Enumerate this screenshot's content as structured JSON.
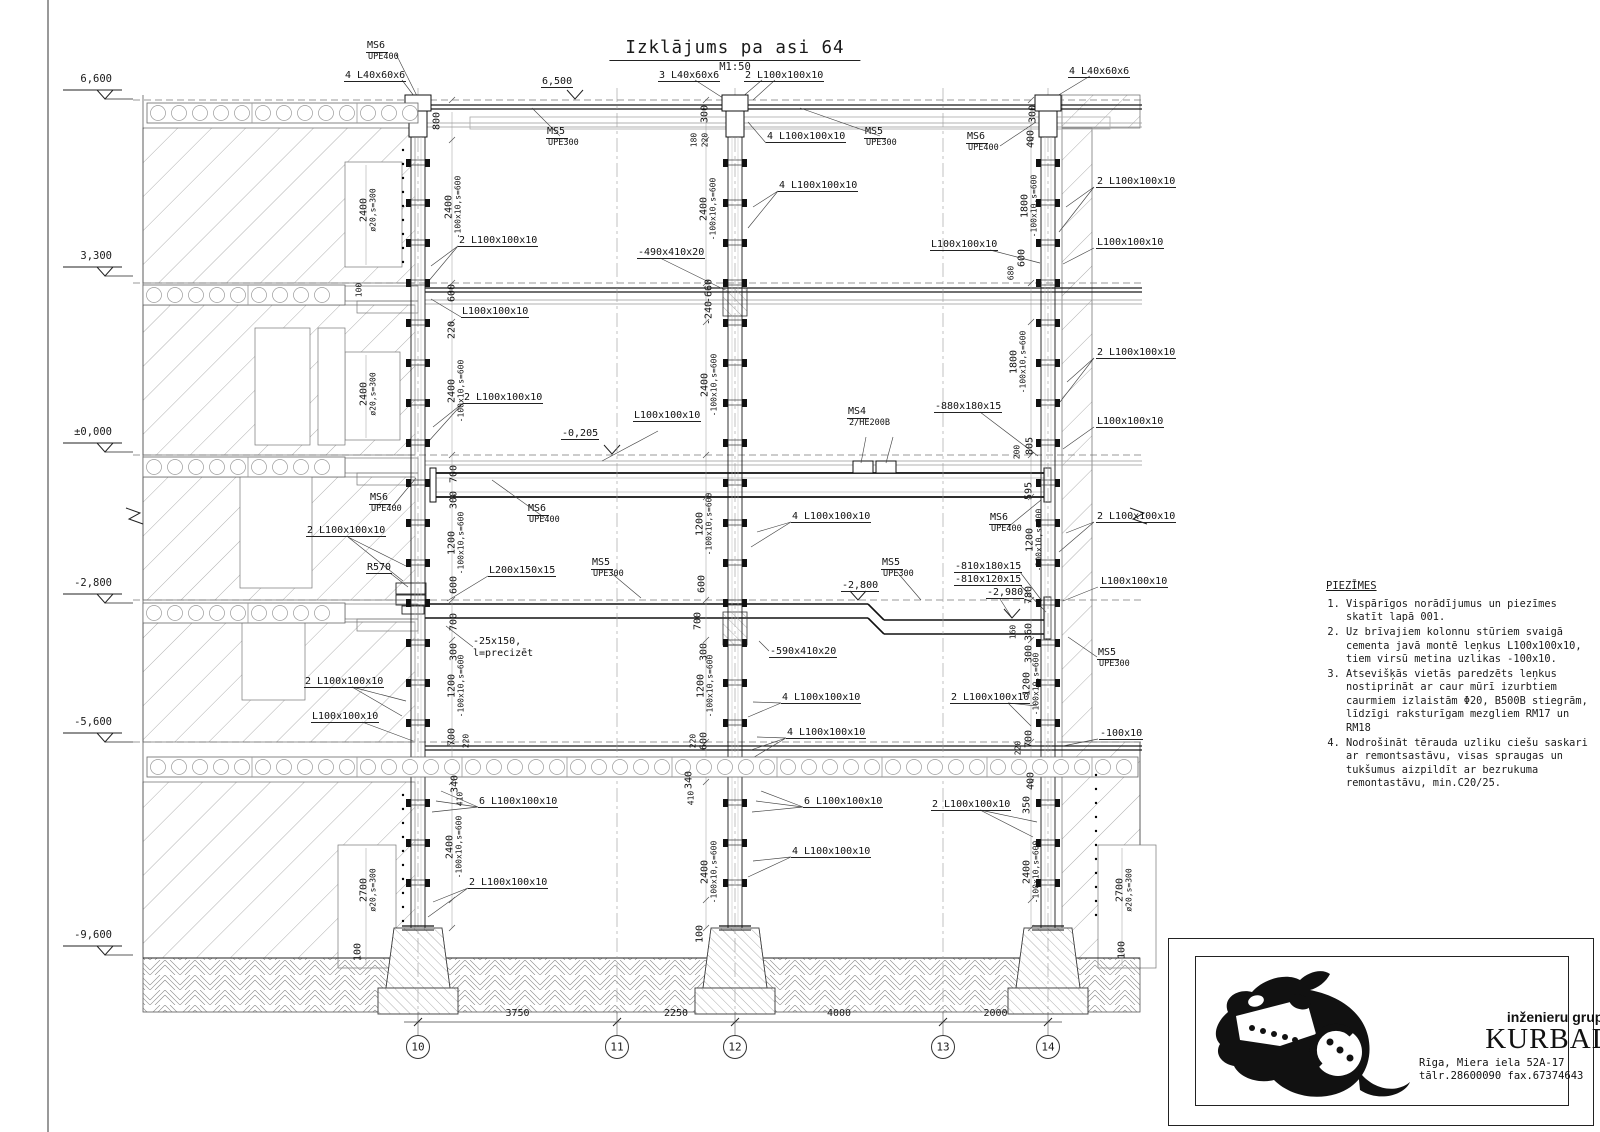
{
  "sheet": {
    "title": "Izklājums pa asi 64",
    "scale": "M1:50"
  },
  "elevation_markers": [
    {
      "label": "6,600",
      "y": 99
    },
    {
      "label": "3,300",
      "y": 276
    },
    {
      "label": "±0,000",
      "y": 452
    },
    {
      "label": "-2,800",
      "y": 603
    },
    {
      "label": "-5,600",
      "y": 742
    },
    {
      "label": "-9,600",
      "y": 955
    }
  ],
  "axes": {
    "bubbles": [
      {
        "label": "10",
        "x": 418
      },
      {
        "label": "11",
        "x": 617
      },
      {
        "label": "12",
        "x": 735
      },
      {
        "label": "13",
        "x": 943
      },
      {
        "label": "14",
        "x": 1048
      }
    ],
    "spans": [
      {
        "label": "3750"
      },
      {
        "label": "2250"
      },
      {
        "label": "4000"
      },
      {
        "label": "2000"
      }
    ]
  },
  "notes": {
    "heading": "PIEZĪMES",
    "items": [
      "Vispārīgos norādījumus un piezīmes skatīt lapā 001.",
      "Uz brīvajiem kolonnu stūriem svaigā cementa javā montē leņkus L100x100x10, tiem virsū metina uzlikas -100x10.",
      "Atsevišķās vietās paredzēts leņkus nostiprināt ar caur mūrī izurbtiem caurmiem izlaistām Φ20, B500B stiegrām, līdzīgi raksturīgam mezgliem RM17 un RM18",
      "Nodrošināt tērauda uzliku ciešu saskari ar remontsastāvu, visas spraugas un tukšumus aizpildīt ar bezrukuma remontastāvu, min.C20/25."
    ]
  },
  "title_block": {
    "tagline": "inženieru grupa",
    "company": "KURBADS",
    "address": "Rīga, Miera iela 52A-17",
    "contacts": "tālr.28600090 fax.67374643"
  },
  "annotations": [
    {
      "t": "MS6",
      "sub": "UPE400",
      "x": 366,
      "y": 40
    },
    {
      "t": "4 L40x60x6",
      "x": 344,
      "y": 70,
      "u": 1
    },
    {
      "t": "6,500",
      "x": 541,
      "y": 76,
      "u": 1
    },
    {
      "t": "3 L40x60x6",
      "x": 658,
      "y": 70,
      "u": 1
    },
    {
      "t": "2 L100x100x10",
      "x": 744,
      "y": 70,
      "u": 1
    },
    {
      "t": "4 L40x60x6",
      "x": 1068,
      "y": 66,
      "u": 1
    },
    {
      "t": "MS5",
      "sub": "UPE300",
      "x": 546,
      "y": 126
    },
    {
      "t": "4 L100x100x10",
      "x": 766,
      "y": 131,
      "u": 1
    },
    {
      "t": "MS5",
      "sub": "UPE300",
      "x": 864,
      "y": 126
    },
    {
      "t": "MS6",
      "sub": "UPE400",
      "x": 966,
      "y": 131
    },
    {
      "t": "2 L100x100x10",
      "x": 1096,
      "y": 176,
      "u": 1
    },
    {
      "t": "4 L100x100x10",
      "x": 778,
      "y": 180,
      "u": 1
    },
    {
      "t": "2 L100x100x10",
      "x": 458,
      "y": 235,
      "u": 1
    },
    {
      "t": "-490x410x20",
      "x": 637,
      "y": 247,
      "u": 1
    },
    {
      "t": "L100x100x10",
      "x": 930,
      "y": 239,
      "u": 1
    },
    {
      "t": "L100x100x10",
      "x": 1096,
      "y": 237,
      "u": 1
    },
    {
      "t": "L100x100x10",
      "x": 461,
      "y": 306,
      "u": 1
    },
    {
      "t": "2 L100x100x10",
      "x": 1096,
      "y": 347,
      "u": 1
    },
    {
      "t": "2 L100x100x10",
      "x": 463,
      "y": 392,
      "u": 1
    },
    {
      "t": "L100x100x10",
      "x": 633,
      "y": 410,
      "u": 1
    },
    {
      "t": "MS4",
      "sub": "2/HE200B",
      "x": 847,
      "y": 406
    },
    {
      "t": "-880x180x15",
      "x": 934,
      "y": 401,
      "u": 1
    },
    {
      "t": "-0,205",
      "x": 561,
      "y": 428,
      "u": 1
    },
    {
      "t": "L100x100x10",
      "x": 1096,
      "y": 416,
      "u": 1
    },
    {
      "t": "MS6",
      "sub": "UPE400",
      "x": 369,
      "y": 492
    },
    {
      "t": "MS6",
      "sub": "UPE400",
      "x": 527,
      "y": 503
    },
    {
      "t": "4 L100x100x10",
      "x": 791,
      "y": 511,
      "u": 1
    },
    {
      "t": "MS6",
      "sub": "UPE400",
      "x": 989,
      "y": 512
    },
    {
      "t": "2 L100x100x10",
      "x": 1096,
      "y": 511,
      "u": 1
    },
    {
      "t": "2 L100x100x10",
      "x": 306,
      "y": 525,
      "u": 1
    },
    {
      "t": "R570",
      "x": 366,
      "y": 562,
      "u": 1
    },
    {
      "t": "L200x150x15",
      "x": 488,
      "y": 565,
      "u": 1
    },
    {
      "t": "MS5",
      "sub": "UPE300",
      "x": 591,
      "y": 557
    },
    {
      "t": "MS5",
      "sub": "UPE300",
      "x": 881,
      "y": 557
    },
    {
      "t": "-810x180x15",
      "x": 954,
      "y": 561,
      "u": 1
    },
    {
      "t": "-810x120x15",
      "x": 954,
      "y": 574,
      "u": 1
    },
    {
      "t": "-2,800",
      "x": 841,
      "y": 580,
      "u": 1
    },
    {
      "t": "-2,980",
      "x": 986,
      "y": 587,
      "u": 1
    },
    {
      "t": "L100x100x10",
      "x": 1100,
      "y": 576,
      "u": 1
    },
    {
      "t": "-25x150,",
      "x": 473,
      "y": 636
    },
    {
      "t": "l=precizēt",
      "x": 473,
      "y": 648
    },
    {
      "t": "MS5",
      "sub": "UPE300",
      "x": 1097,
      "y": 647
    },
    {
      "t": "2 L100x100x10",
      "x": 950,
      "y": 692,
      "u": 1
    },
    {
      "t": "4 L100x100x10",
      "x": 781,
      "y": 692,
      "u": 1
    },
    {
      "t": "-590x410x20",
      "x": 769,
      "y": 646,
      "u": 1
    },
    {
      "t": "-100x10",
      "x": 1099,
      "y": 728,
      "u": 1
    },
    {
      "t": "2 L100x100x10",
      "x": 304,
      "y": 676,
      "u": 1
    },
    {
      "t": "L100x100x10",
      "x": 311,
      "y": 711,
      "u": 1
    },
    {
      "t": "4 L100x100x10",
      "x": 786,
      "y": 727,
      "u": 1
    },
    {
      "t": "6 L100x100x10",
      "x": 478,
      "y": 796,
      "u": 1
    },
    {
      "t": "6 L100x100x10",
      "x": 803,
      "y": 796,
      "u": 1
    },
    {
      "t": "2 L100x100x10",
      "x": 468,
      "y": 877,
      "u": 1
    },
    {
      "t": "4 L100x100x10",
      "x": 791,
      "y": 846,
      "u": 1
    },
    {
      "t": "2 L100x100x10",
      "x": 931,
      "y": 799,
      "u": 1
    },
    {
      "t": "800",
      "x": 437,
      "y": 121,
      "r": 1
    },
    {
      "t": "2400",
      "x": 449,
      "y": 207,
      "r": 1
    },
    {
      "t": "-100x10,s=600",
      "x": 459,
      "y": 207,
      "r": 1,
      "s": 8
    },
    {
      "t": "2400",
      "x": 364,
      "y": 210,
      "r": 1
    },
    {
      "t": "ø20,s=300",
      "x": 374,
      "y": 210,
      "r": 1,
      "s": 8
    },
    {
      "t": "100",
      "x": 360,
      "y": 290,
      "r": 1,
      "s": 8
    },
    {
      "t": "600",
      "x": 452,
      "y": 293,
      "r": 1
    },
    {
      "t": "220",
      "x": 452,
      "y": 330,
      "r": 1
    },
    {
      "t": "2400",
      "x": 452,
      "y": 391,
      "r": 1
    },
    {
      "t": "-100x10,s=600",
      "x": 462,
      "y": 391,
      "r": 1,
      "s": 8
    },
    {
      "t": "2400",
      "x": 364,
      "y": 394,
      "r": 1
    },
    {
      "t": "ø20,s=300",
      "x": 374,
      "y": 394,
      "r": 1,
      "s": 8
    },
    {
      "t": "700",
      "x": 454,
      "y": 474,
      "r": 1
    },
    {
      "t": "300",
      "x": 454,
      "y": 500,
      "r": 1
    },
    {
      "t": "1200",
      "x": 452,
      "y": 543,
      "r": 1
    },
    {
      "t": "-100x10,s=600",
      "x": 462,
      "y": 543,
      "r": 1,
      "s": 8
    },
    {
      "t": "600",
      "x": 454,
      "y": 585,
      "r": 1
    },
    {
      "t": "700",
      "x": 454,
      "y": 622,
      "r": 1
    },
    {
      "t": "300",
      "x": 454,
      "y": 652,
      "r": 1
    },
    {
      "t": "1200",
      "x": 452,
      "y": 686,
      "r": 1
    },
    {
      "t": "-100x10,s=600",
      "x": 462,
      "y": 686,
      "r": 1,
      "s": 8
    },
    {
      "t": "700",
      "x": 452,
      "y": 737,
      "r": 1
    },
    {
      "t": "220",
      "x": 467,
      "y": 741,
      "r": 1,
      "s": 8
    },
    {
      "t": "340",
      "x": 455,
      "y": 784,
      "r": 1
    },
    {
      "t": "410",
      "x": 461,
      "y": 799,
      "r": 1,
      "s": 8
    },
    {
      "t": "2400",
      "x": 450,
      "y": 847,
      "r": 1
    },
    {
      "t": "-100x10,s=600",
      "x": 460,
      "y": 847,
      "r": 1,
      "s": 8
    },
    {
      "t": "2700",
      "x": 364,
      "y": 890,
      "r": 1
    },
    {
      "t": "ø20,s=300",
      "x": 374,
      "y": 890,
      "r": 1,
      "s": 8
    },
    {
      "t": "100",
      "x": 358,
      "y": 952,
      "r": 1
    },
    {
      "t": "300",
      "x": 705,
      "y": 114,
      "r": 1
    },
    {
      "t": "180",
      "x": 695,
      "y": 140,
      "r": 1,
      "s": 8
    },
    {
      "t": "220",
      "x": 706,
      "y": 140,
      "r": 1,
      "s": 8
    },
    {
      "t": "2400",
      "x": 704,
      "y": 209,
      "r": 1
    },
    {
      "t": "-100x10,s=600",
      "x": 714,
      "y": 209,
      "r": 1,
      "s": 8
    },
    {
      "t": "-660",
      "x": 709,
      "y": 291,
      "r": 1
    },
    {
      "t": "-240",
      "x": 709,
      "y": 313,
      "r": 1
    },
    {
      "t": "2400",
      "x": 705,
      "y": 385,
      "r": 1
    },
    {
      "t": "-100x10,s=600",
      "x": 715,
      "y": 385,
      "r": 1,
      "s": 8
    },
    {
      "t": "1200",
      "x": 700,
      "y": 524,
      "r": 1
    },
    {
      "t": "-100x10,s=600",
      "x": 710,
      "y": 524,
      "r": 1,
      "s": 8
    },
    {
      "t": "600",
      "x": 702,
      "y": 584,
      "r": 1
    },
    {
      "t": "700",
      "x": 698,
      "y": 621,
      "r": 1
    },
    {
      "t": "300",
      "x": 704,
      "y": 652,
      "r": 1
    },
    {
      "t": "1200",
      "x": 701,
      "y": 686,
      "r": 1
    },
    {
      "t": "-100x10,s=600",
      "x": 711,
      "y": 686,
      "r": 1,
      "s": 8
    },
    {
      "t": "220",
      "x": 694,
      "y": 741,
      "r": 1,
      "s": 8
    },
    {
      "t": "600",
      "x": 704,
      "y": 741,
      "r": 1
    },
    {
      "t": "340",
      "x": 689,
      "y": 780,
      "r": 1
    },
    {
      "t": "410",
      "x": 692,
      "y": 798,
      "r": 1,
      "s": 8
    },
    {
      "t": "2400",
      "x": 705,
      "y": 872,
      "r": 1
    },
    {
      "t": "-100x10,s=600",
      "x": 715,
      "y": 872,
      "r": 1,
      "s": 8
    },
    {
      "t": "100",
      "x": 700,
      "y": 934,
      "r": 1
    },
    {
      "t": "300",
      "x": 1033,
      "y": 114,
      "r": 1
    },
    {
      "t": "400",
      "x": 1031,
      "y": 139,
      "r": 1
    },
    {
      "t": "1800",
      "x": 1025,
      "y": 206,
      "r": 1
    },
    {
      "t": "-100x10,s=600",
      "x": 1035,
      "y": 206,
      "r": 1,
      "s": 8
    },
    {
      "t": "600",
      "x": 1022,
      "y": 258,
      "r": 1
    },
    {
      "t": "680",
      "x": 1012,
      "y": 273,
      "r": 1,
      "s": 8
    },
    {
      "t": "1800",
      "x": 1014,
      "y": 362,
      "r": 1
    },
    {
      "t": "-100x10,s=600",
      "x": 1024,
      "y": 362,
      "r": 1,
      "s": 8
    },
    {
      "t": "805",
      "x": 1030,
      "y": 446,
      "r": 1
    },
    {
      "t": "200",
      "x": 1018,
      "y": 452,
      "r": 1,
      "s": 8
    },
    {
      "t": "595",
      "x": 1029,
      "y": 491,
      "r": 1
    },
    {
      "t": "1200",
      "x": 1030,
      "y": 540,
      "r": 1
    },
    {
      "t": "-100x10,s=600",
      "x": 1040,
      "y": 540,
      "r": 1,
      "s": 8
    },
    {
      "t": "780",
      "x": 1029,
      "y": 595,
      "r": 1
    },
    {
      "t": "160",
      "x": 1014,
      "y": 632,
      "r": 1,
      "s": 8
    },
    {
      "t": "360",
      "x": 1029,
      "y": 632,
      "r": 1
    },
    {
      "t": "300",
      "x": 1029,
      "y": 654,
      "r": 1
    },
    {
      "t": "1200",
      "x": 1027,
      "y": 684,
      "r": 1
    },
    {
      "t": "-100x10,s=600",
      "x": 1037,
      "y": 684,
      "r": 1,
      "s": 8
    },
    {
      "t": "700",
      "x": 1029,
      "y": 739,
      "r": 1
    },
    {
      "t": "220",
      "x": 1019,
      "y": 748,
      "r": 1,
      "s": 8
    },
    {
      "t": "400",
      "x": 1031,
      "y": 781,
      "r": 1
    },
    {
      "t": "350",
      "x": 1027,
      "y": 805,
      "r": 1
    },
    {
      "t": "2400",
      "x": 1027,
      "y": 872,
      "r": 1
    },
    {
      "t": "-100x10,s=600",
      "x": 1037,
      "y": 872,
      "r": 1,
      "s": 8
    },
    {
      "t": "2700",
      "x": 1120,
      "y": 890,
      "r": 1
    },
    {
      "t": "ø20,s=300",
      "x": 1130,
      "y": 890,
      "r": 1,
      "s": 8
    },
    {
      "t": "100",
      "x": 1122,
      "y": 950,
      "r": 1
    }
  ]
}
